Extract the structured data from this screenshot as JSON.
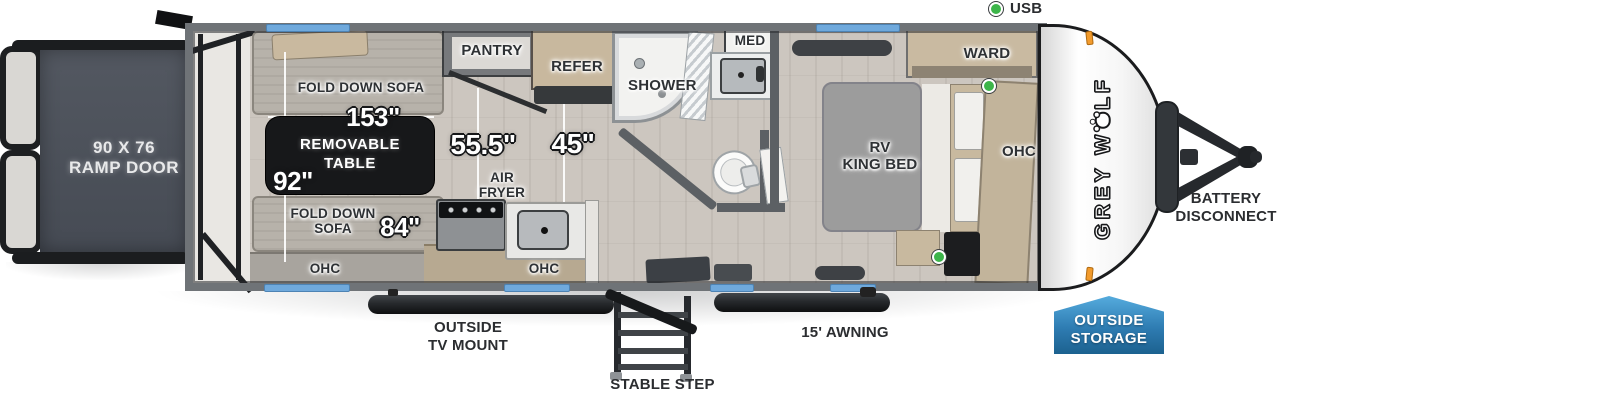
{
  "diagram": {
    "usb_label": "USB",
    "ramp_line1": "90 X 76",
    "ramp_line2": "RAMP DOOR",
    "tv_mount_line1": "OUTSIDE",
    "tv_mount_line2": "TV MOUNT",
    "stable_step_label": "STABLE STEP",
    "awning_label": "15' AWNING",
    "battery_line1": "BATTERY",
    "battery_line2": "DISCONNECT",
    "storage_line1": "OUTSIDE",
    "storage_line2": "STORAGE",
    "brand_prefix": "GREY W",
    "brand_suffix": "LF"
  },
  "living": {
    "sofa_top_label": "FOLD DOWN SOFA",
    "dim_length": "153\"",
    "table_line1": "REMOVABLE",
    "table_line2": "TABLE",
    "dim_width": "92\"",
    "sofa_bottom_line1": "FOLD DOWN",
    "sofa_bottom_line2": "SOFA",
    "dim_sofa": "84\"",
    "ohc_label": "OHC"
  },
  "kitchen": {
    "pantry_label": "PANTRY",
    "refer_label": "REFER",
    "dim_galley": "55.5\"",
    "dim_entry": "45\"",
    "airfryer_line1": "AIR",
    "airfryer_line2": "FRYER",
    "ohc_label": "OHC"
  },
  "bath": {
    "shower_label": "SHOWER",
    "med_label": "MED"
  },
  "bedroom": {
    "ward_label": "WARD",
    "bed_line1": "RV",
    "bed_line2": "KING BED",
    "ohc_label": "OHC"
  },
  "colors": {
    "window_blue": "#6fa9dc",
    "usb_green": "#3db54a",
    "marker_orange": "#f29b2d",
    "badge_blue_dark": "#1c618f",
    "badge_blue_light": "#55abdd",
    "wall_gray": "#6f7377",
    "ramp_charcoal": "#4a505a",
    "table_black": "#17181a"
  }
}
